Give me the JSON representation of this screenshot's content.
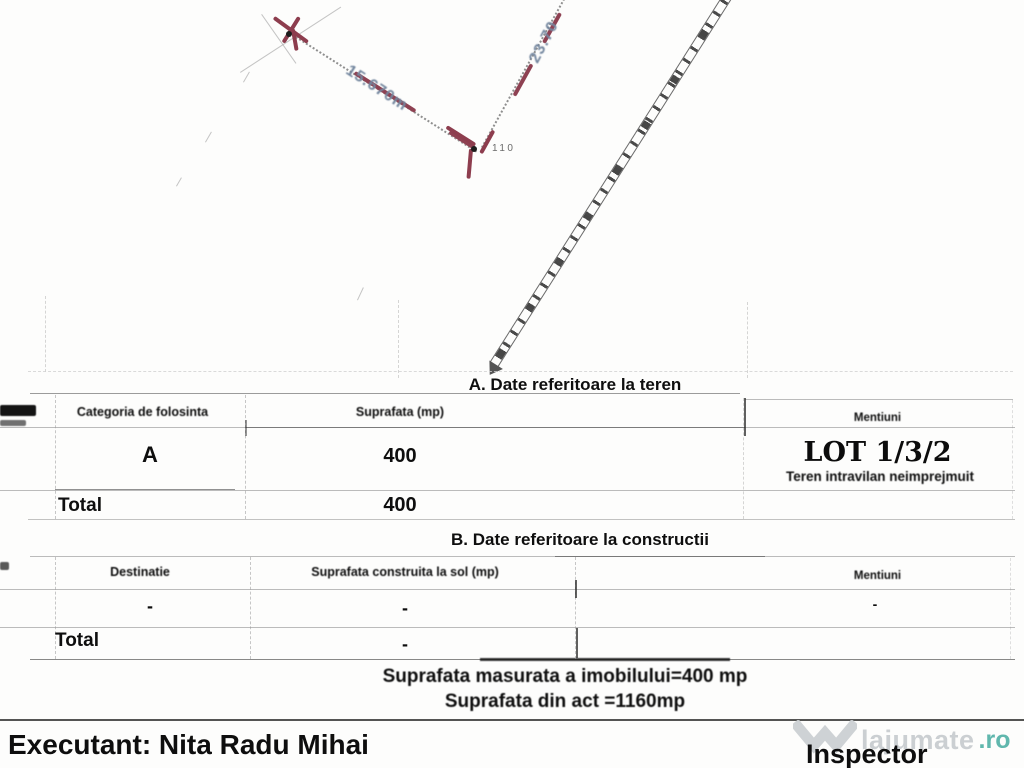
{
  "plan": {
    "point_label": "110",
    "dim_ab": "15.670m",
    "dim_bc": "23.70"
  },
  "section_a": {
    "title": "A. Date referitoare la teren",
    "headers": {
      "categoria": "Categoria de folosinta",
      "suprafata": "Suprafata (mp)",
      "mentiuni": "Mentiuni"
    },
    "row": {
      "categoria": "A",
      "suprafata": "400"
    },
    "mentiuni_lot": "LOT 1/3/2",
    "mentiuni_note": "Teren intravilan neimprejmuit",
    "total": {
      "label": "Total",
      "value": "400"
    }
  },
  "section_b": {
    "title": "B. Date referitoare la constructii",
    "headers": {
      "destinatie": "Destinatie",
      "suprafata": "Suprafata construita la sol (mp)",
      "mentiuni": "Mentiuni"
    },
    "row": {
      "destinatie": "-",
      "suprafata": "-",
      "mentiuni": "-"
    },
    "total": {
      "label": "Total",
      "value": "-"
    }
  },
  "summary": {
    "line1": "Suprafata masurata a imobilului=400 mp",
    "line2": "Suprafata din act =1160mp"
  },
  "footer": {
    "executant": "Executant: Nita Radu Mihai",
    "inspector": "Inspector"
  },
  "watermark": {
    "brand": "lajumate",
    "tld": ".ro"
  },
  "colors": {
    "marker_red": "#8d3d4e",
    "dimension_blue": "#74879f",
    "watermark_gray": "#c9cdd0",
    "watermark_teal": "#58b4a9"
  }
}
